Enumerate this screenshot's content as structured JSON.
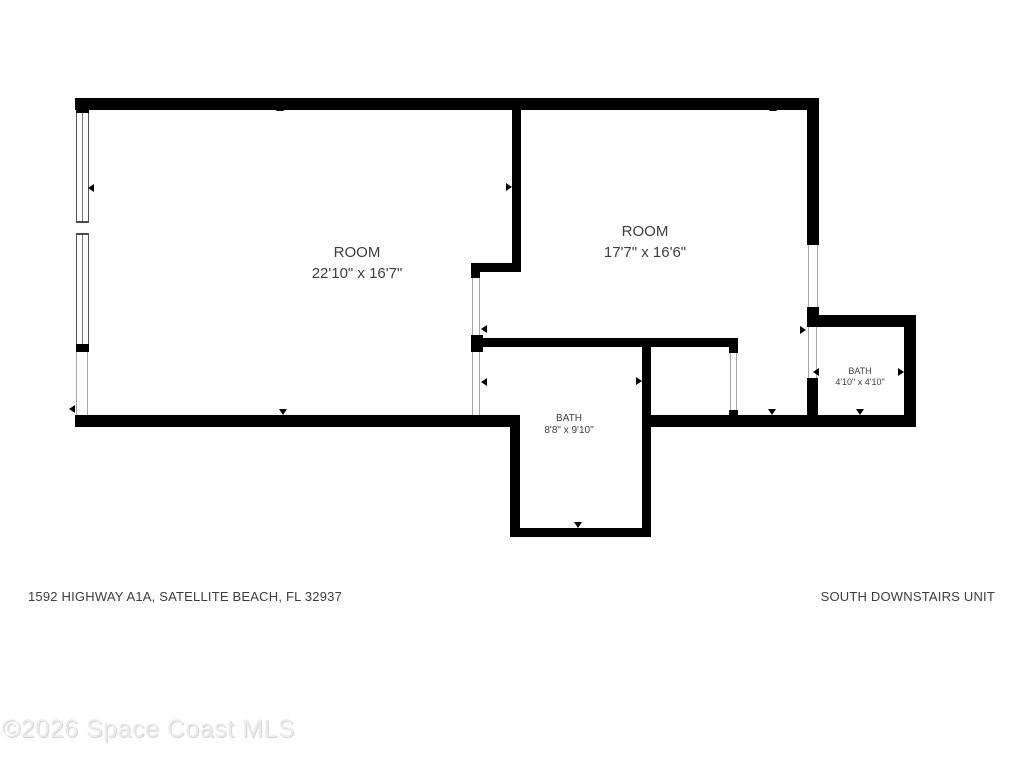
{
  "floor_plan": {
    "rooms": [
      {
        "name": "ROOM",
        "dimensions": "22'10\" x 16'7\""
      },
      {
        "name": "ROOM",
        "dimensions": "17'7\" x 16'6\""
      },
      {
        "name": "BATH",
        "dimensions": "8'8\" x 9'10\""
      },
      {
        "name": "BATH",
        "dimensions": "4'10\" x 4'10\""
      }
    ],
    "address": "1592 HIGHWAY A1A, SATELLITE BEACH, FL 32937",
    "unit_label": "SOUTH DOWNSTAIRS UNIT",
    "watermark": "©2026 Space Coast MLS",
    "icons": {
      "measurement_arrow": "small solid triangle marker on walls",
      "window": "double-line window symbol with center mullion"
    },
    "colors": {
      "wall": "#000000",
      "text": "#3d3d3d",
      "watermark_fill": "#ececec",
      "watermark_shadow": "#d6d6d6",
      "background": "#ffffff"
    }
  }
}
